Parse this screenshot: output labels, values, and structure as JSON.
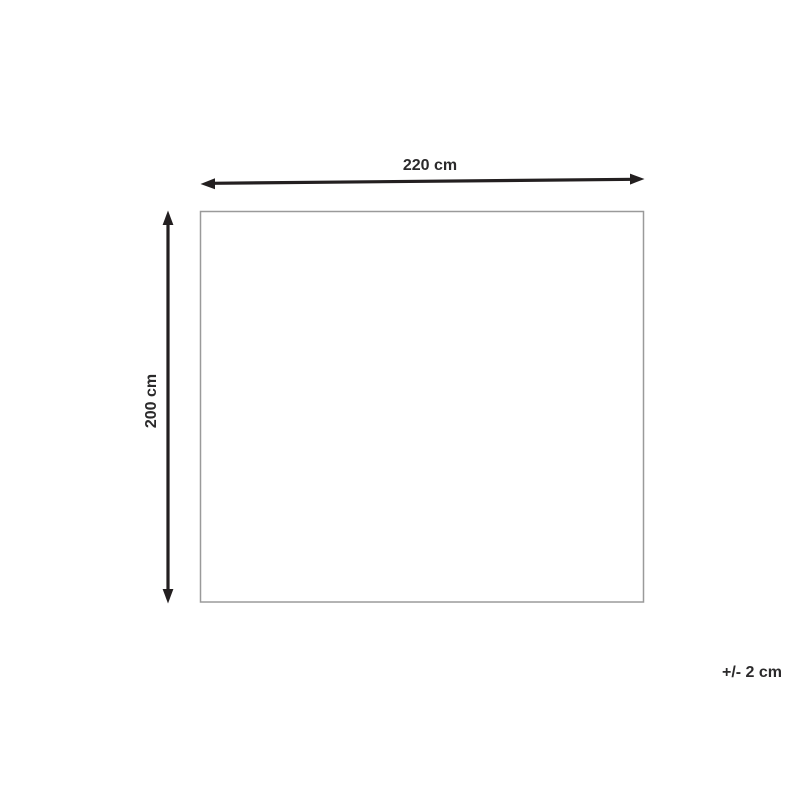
{
  "diagram": {
    "type": "product-dimension-diagram",
    "width_label": "220 cm",
    "height_label": "200 cm",
    "tolerance_label": "+/- 2 cm",
    "dimensions": {
      "width_cm": 220,
      "height_cm": 200,
      "tolerance_cm": 2
    },
    "colors": {
      "arrow": "#231f20",
      "text": "#2b2a2b",
      "rectangle_border": "#9a9a9a",
      "background": "#ffffff"
    }
  }
}
